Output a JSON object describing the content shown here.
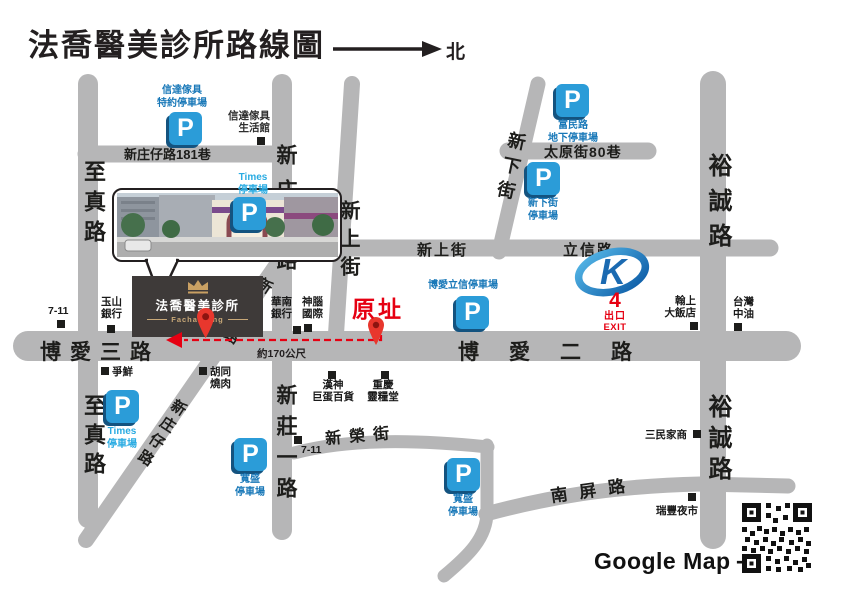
{
  "title": "法喬醫美診所路線圖",
  "compass": {
    "north": "北"
  },
  "roads": {
    "zhizhen": "至真路",
    "xinzhuangzai": "新庄仔路",
    "xinzhuangzai_lane181": "新庄仔路181巷",
    "xinzhuang_yi_rd": "新莊一路",
    "xinshang_st": "新上街",
    "lixin_rd": "立信路",
    "xinxia_st": "新下街",
    "taiyuan_lane80": "太原街80巷",
    "yucheng_rd": "裕誠路",
    "boai_3rd_rd": "博愛三路",
    "boai_2nd_rd": "博愛二路",
    "xinrong_st": "新榮街",
    "nanping_rd": "南屏路"
  },
  "clinic": {
    "name": "法喬醫美診所",
    "brand": "Facharming"
  },
  "origin": {
    "label": "原址",
    "distance_note": "約170公尺"
  },
  "mrt": {
    "logo_letter": "K",
    "exit_number": "4",
    "exit_zh": "出口",
    "exit_en": "EXIT"
  },
  "parking": {
    "p": "P",
    "furniture_reserved": {
      "line1": "信達傢具",
      "line2": "特約停車場"
    },
    "times_north": {
      "line1": "Times",
      "line2": "停車場"
    },
    "fumin_underground": {
      "line1": "富民路",
      "line2": "地下停車場"
    },
    "xinxia": {
      "line1": "新下街",
      "line2": "停車場"
    },
    "boai_lixin": "博愛立信停車場",
    "times_south": {
      "line1": "Times",
      "line2": "停車場"
    },
    "kuansheng_west": {
      "line1": "寬盛",
      "line2": "停車場"
    },
    "kuansheng_east": {
      "line1": "寬盛",
      "line2": "停車場"
    }
  },
  "landmarks": {
    "seven_eleven_west": "7-11",
    "seven_eleven_south": "7-11",
    "esun_bank": {
      "line1": "玉山",
      "line2": "銀行"
    },
    "huanan_bank": {
      "line1": "華南",
      "line2": "銀行"
    },
    "senao": {
      "line1": "神腦",
      "line2": "國際"
    },
    "furniture_store": {
      "line1": "信達傢具",
      "line2": "生活館"
    },
    "sushi": "爭鮮",
    "bbq": {
      "line1": "胡同",
      "line2": "燒肉"
    },
    "hanshin_arena": {
      "line1": "漢神",
      "line2": "巨蛋百貨"
    },
    "lingliang_hall": {
      "line1": "重慶",
      "line2": "靈糧堂"
    },
    "hotel": {
      "line1": "翰上",
      "line2": "大飯店"
    },
    "cpc_gas": {
      "line1": "台灣",
      "line2": "中油"
    },
    "sanmin_school": "三民家商",
    "ruifeng_market": "瑞豐夜市"
  },
  "footer": {
    "google_map": "Google Map",
    "arrow": "⟶"
  },
  "colors": {
    "road_gray": "#b6b6b7",
    "parking_blue": "#2b9cd8",
    "parking_label_blue": "#1878b8",
    "times_cyan": "#29abe2",
    "accent_red": "#e60012",
    "clinic_dark": "#3e3a39",
    "gold": "#c9a063",
    "mrt_blue": "#0b5aa5"
  }
}
